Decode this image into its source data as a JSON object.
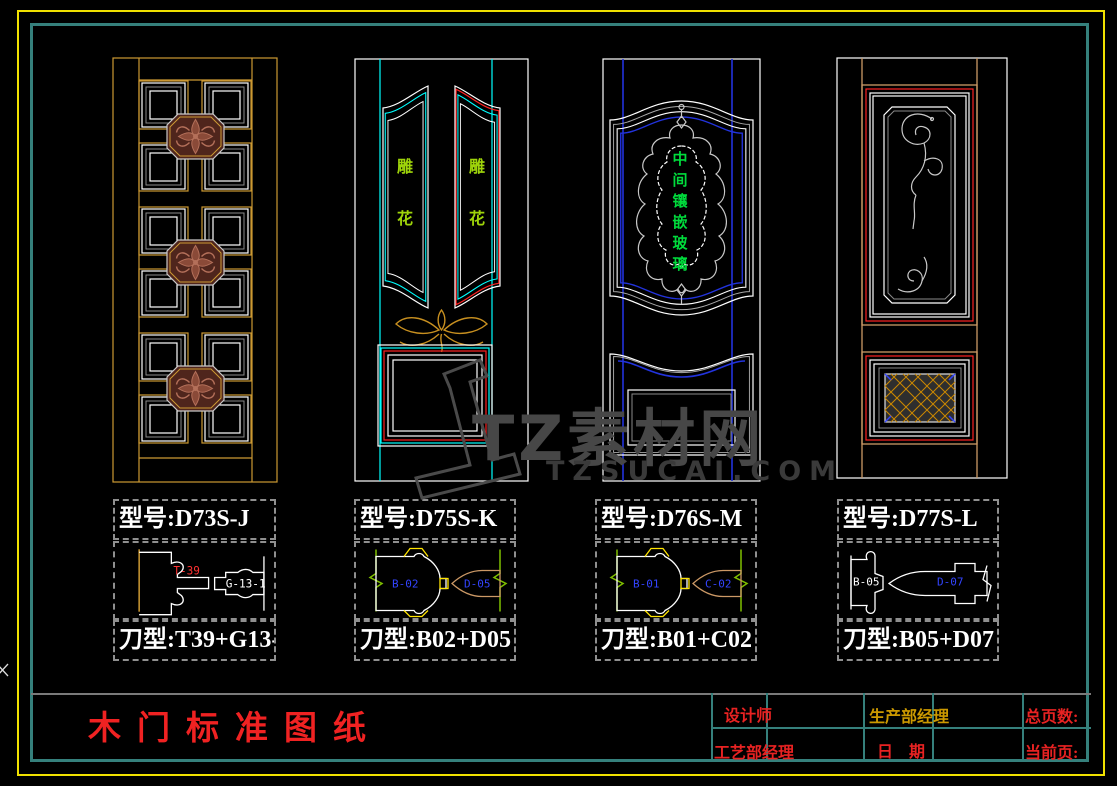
{
  "drawing": {
    "sheet_title": "木门标准图纸",
    "watermark": {
      "brand": "TZ素材网",
      "domain": "TZSUCAI.COM"
    },
    "doors": [
      {
        "id": "door-1",
        "model_label": "型号:D73S-J",
        "knife_label": "刀型:T39+G13-1",
        "profile_labels": [
          "T-39",
          "G-13-1"
        ],
        "panel_chars": []
      },
      {
        "id": "door-2",
        "model_label": "型号:D75S-K",
        "knife_label": "刀型:B02+D05",
        "profile_labels": [
          "B-02",
          "D-05"
        ],
        "panel_chars": [
          "雕",
          "花"
        ]
      },
      {
        "id": "door-3",
        "model_label": "型号:D76S-M",
        "knife_label": "刀型:B01+C02",
        "profile_labels": [
          "B-01",
          "C-02"
        ],
        "panel_chars": [
          "中",
          "间",
          "镶",
          "嵌",
          "玻",
          "璃"
        ]
      },
      {
        "id": "door-4",
        "model_label": "型号:D77S-L",
        "knife_label": "刀型:B05+D07",
        "profile_labels": [
          "B-05",
          "D-07"
        ],
        "panel_chars": []
      }
    ],
    "title_block": {
      "designer_label": "设计师",
      "process_manager_label": "工艺部经理",
      "production_manager_label": "生产部经理",
      "date_label": "日　期",
      "total_pages_label": "总页数:",
      "current_page_label": "当前页:"
    },
    "colors": {
      "background": "#000000",
      "outer_border_yellow": "#F0E100",
      "inner_border_teal": "#35807C",
      "cad_gold": "#CC9933",
      "cad_cyan": "#00FFFF",
      "cad_blue": "#2233DD",
      "cad_red": "#FF2222",
      "cad_tan": "#CC9966",
      "break_line_green": "#7FBF00",
      "panel_text_green": "#00DC3C",
      "carve_text_green": "#9ED40A",
      "title_red": "#F02222",
      "label_gold": "#CC9900",
      "watermark_gray": "#474747"
    }
  }
}
